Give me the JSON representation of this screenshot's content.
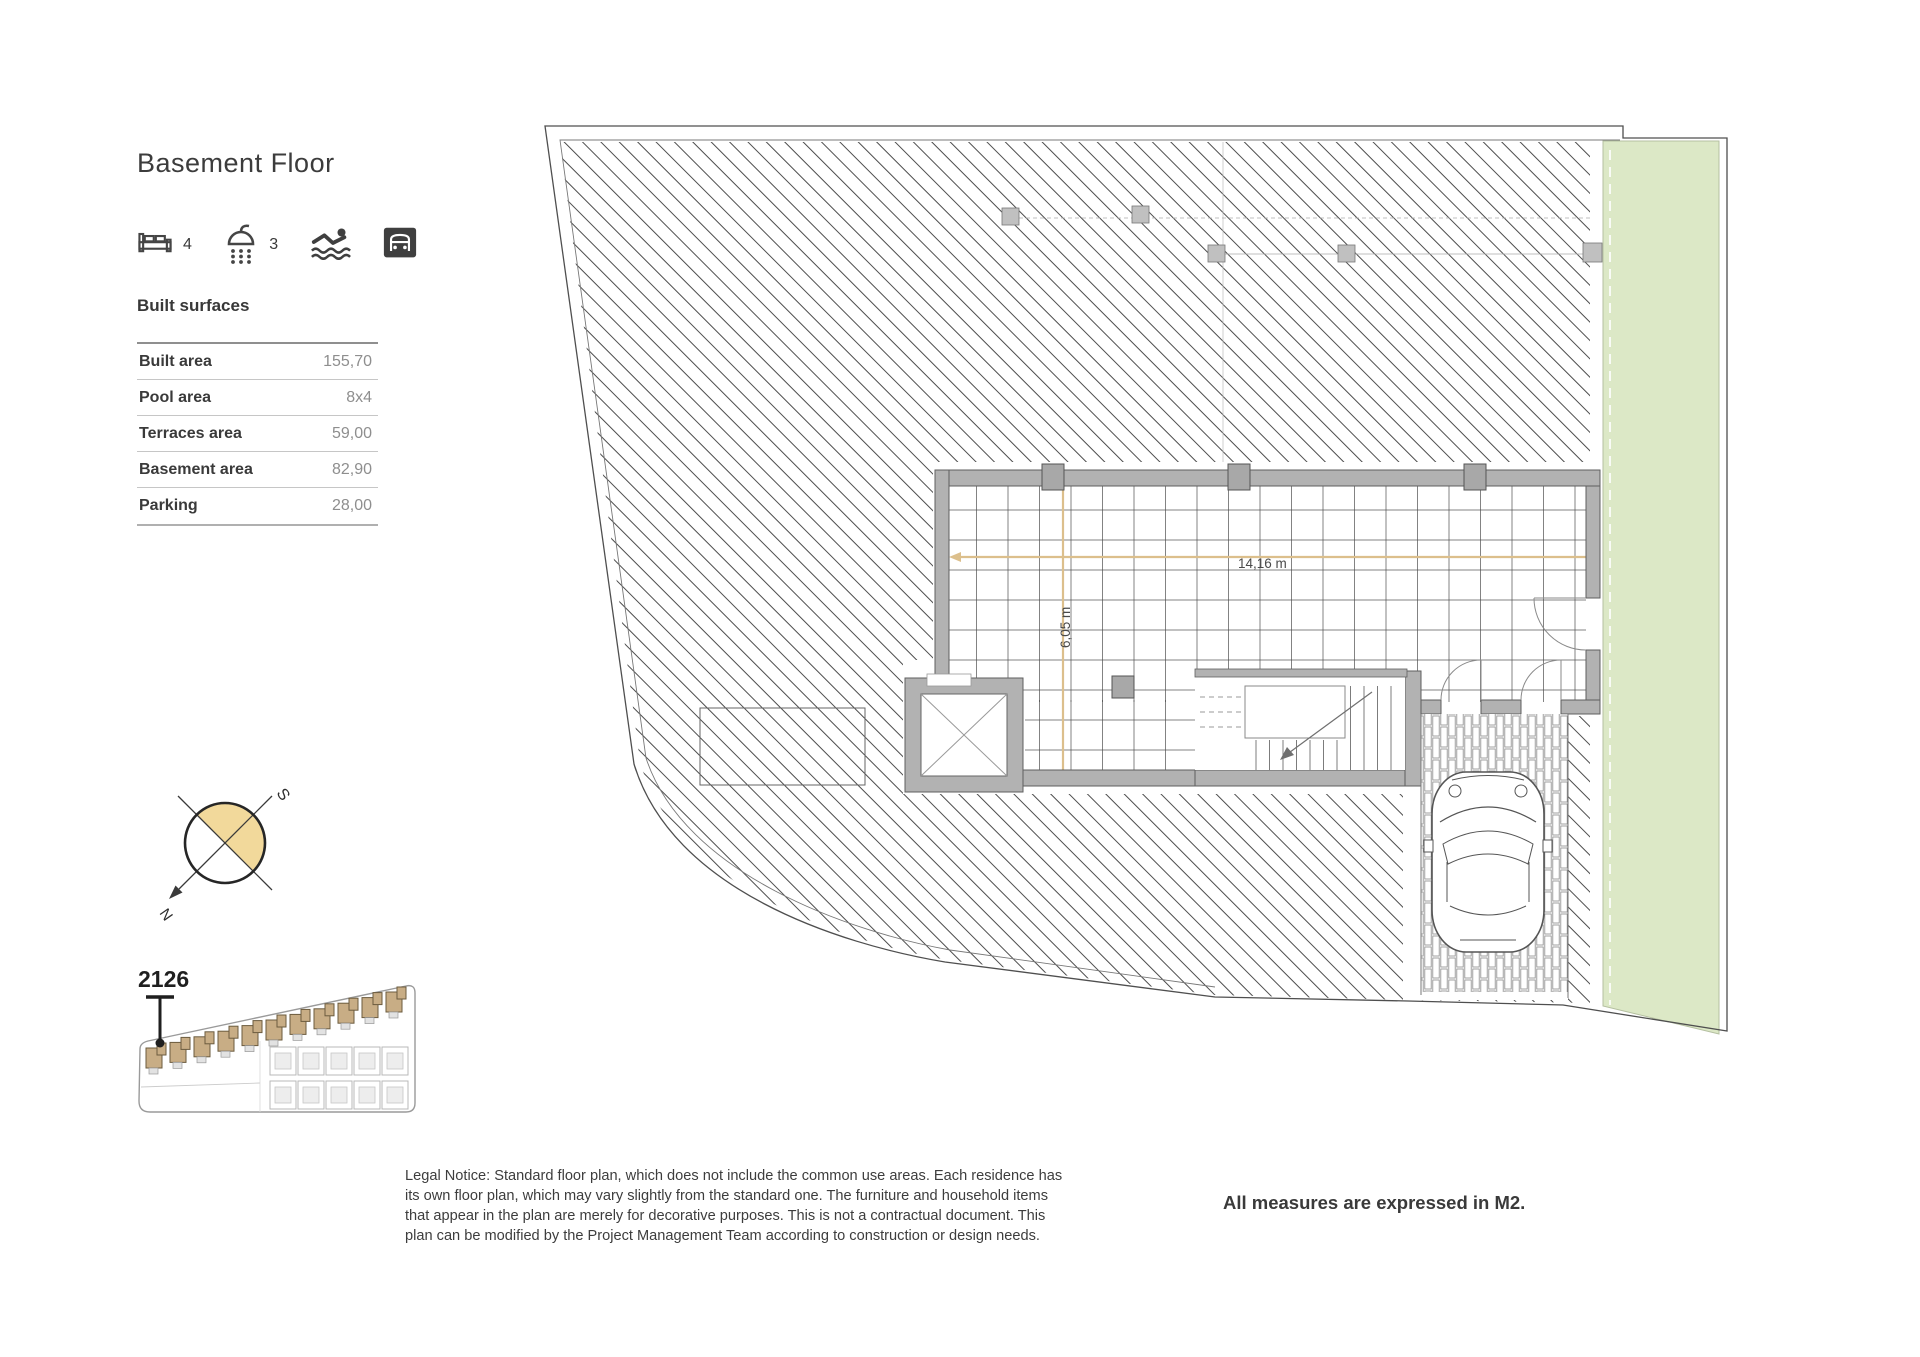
{
  "header": {
    "title": "Basement Floor"
  },
  "amenities": {
    "bedrooms_count": "4",
    "bathrooms_count": "3"
  },
  "built_surfaces": {
    "heading": "Built surfaces",
    "rows": [
      {
        "label": "Built area",
        "value": "155,70"
      },
      {
        "label": "Pool area",
        "value": "8x4"
      },
      {
        "label": "Terraces area",
        "value": "59,00"
      },
      {
        "label": "Basement area",
        "value": "82,90"
      },
      {
        "label": "Parking",
        "value": "28,00"
      }
    ]
  },
  "compass": {
    "south": "S",
    "north": "N"
  },
  "site_plan": {
    "unit_number": "2126"
  },
  "floor_plan": {
    "width_dim": "14,16 m",
    "depth_dim": "6,05 m"
  },
  "footnotes": {
    "legal": "Legal Notice: Standard floor plan, which does not include the common use areas. Each residence has its own floor plan, which may vary slightly from the standard one. The furniture and household items that appear in the plan are merely for decorative purposes. This is not a contractual document. This plan can be modified by the Project Management Team according to construction or design needs.",
    "measures": "All measures are expressed in M2."
  },
  "colors": {
    "green_area": "#dce8c6",
    "wall_gray": "#b2b2b2",
    "dimension_tan": "#dcbf8c",
    "compass_fill": "#f2d99b"
  }
}
